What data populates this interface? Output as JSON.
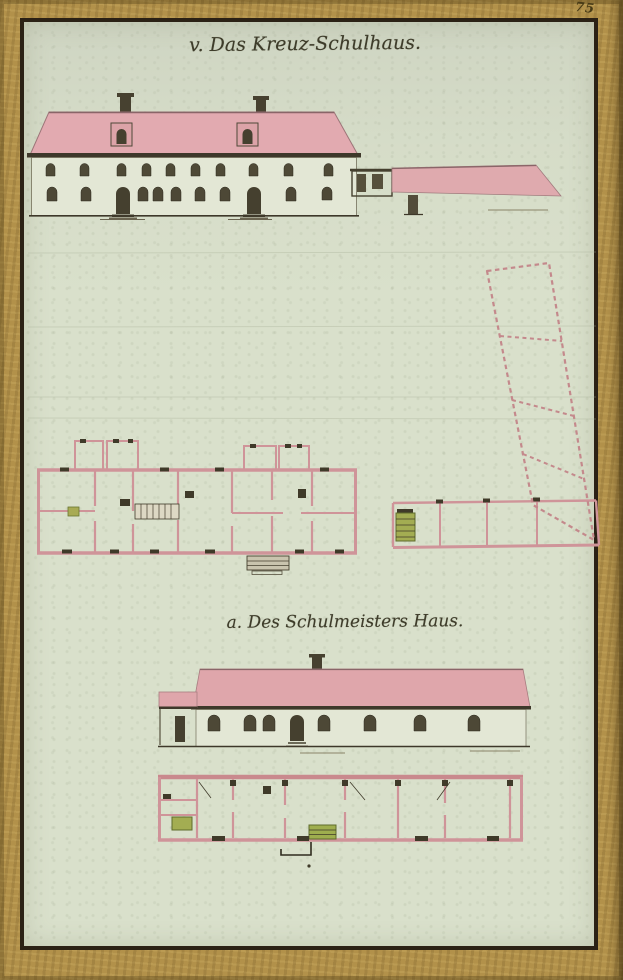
{
  "page": {
    "number": "75"
  },
  "titles": {
    "main": "v. Das Kreuz-Schulhaus.",
    "secondary": "a. Des Schulmeisters Haus."
  },
  "colors": {
    "border_gold": "#b2914a",
    "frame_ink": "#2b2115",
    "paper_green": "#d9e0cb",
    "roof_pink": "#e0a8ad",
    "plan_wall_pink": "#cf9499",
    "ink_dark": "#3f3a29",
    "window_dark": "#4d4836",
    "stove_green": "#a3ad52"
  }
}
